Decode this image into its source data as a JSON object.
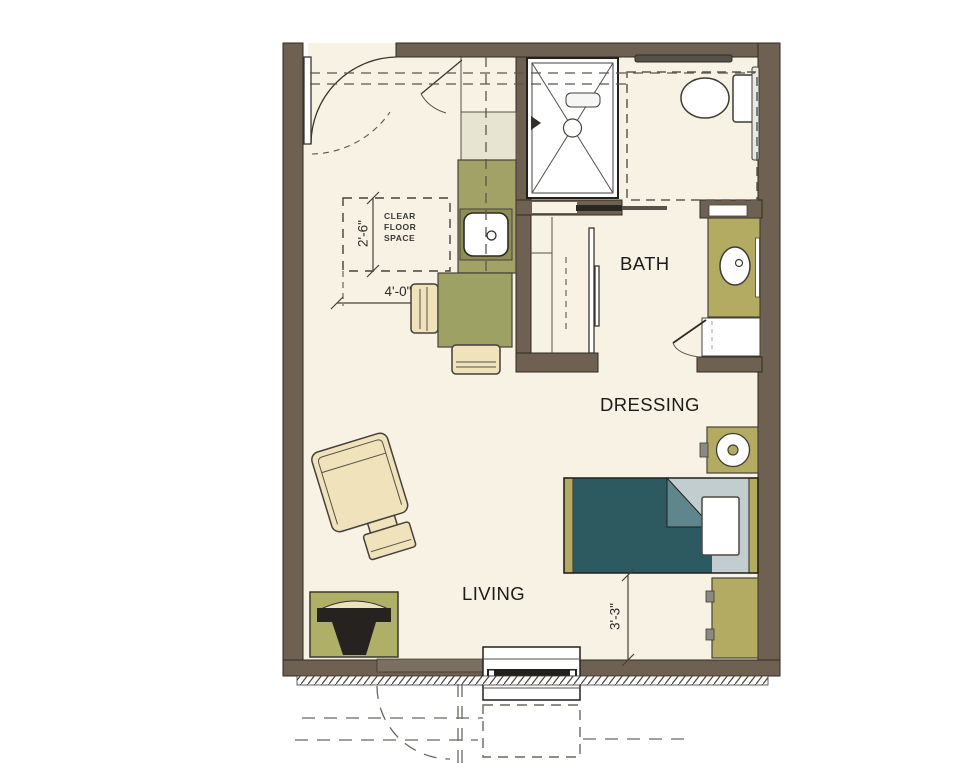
{
  "title": "studio-unit-floor-plan",
  "labels": {
    "bath": "BATH",
    "dressing": "DRESSING",
    "living": "LIVING"
  },
  "annotations": {
    "clear_floor": [
      "CLEAR",
      "FLOOR",
      "SPACE"
    ],
    "dim_counter_clearance": "2'-6\"",
    "dim_kitchen_run": "4'-0\"",
    "dim_bed_clearance": "3'-3\""
  },
  "colors": {
    "wall": "#6e6152",
    "floor": "#f8f2e4",
    "counter": "#a3a266",
    "counter_dark": "#8d8d55",
    "cabinet": "#e7e4d2",
    "furniture_olive": "#b3ab62",
    "table": "#9da163",
    "beige": "#f0e2bb",
    "bed_teal": "#2d5a60",
    "bed_teal_light": "#5e868c",
    "bed_sheet": "#c2cdd0",
    "tv_dark": "#262220"
  }
}
